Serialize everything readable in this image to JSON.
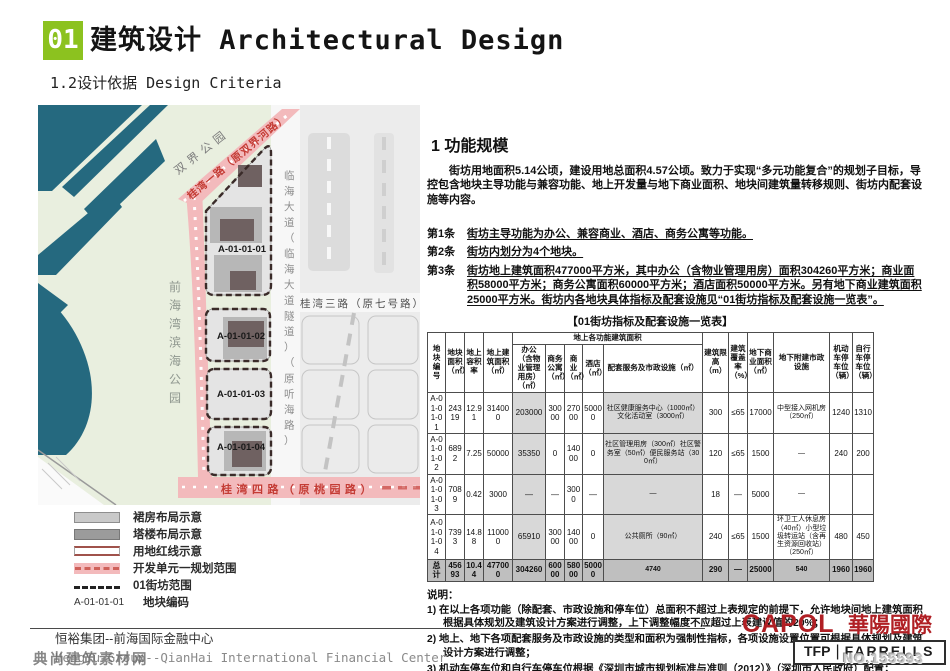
{
  "header": {
    "section_no": "01",
    "title": "建筑设计 Architectural Design",
    "subtitle": "1.2设计依据 Design Criteria"
  },
  "map": {
    "labels": {
      "park_top": "双界公园",
      "park_left": "前海湾滨海公园",
      "road_guiwan1": "桂湾一路（原双界河路）",
      "road_linhai": "临海大道（临海大道隧道）（原听海路）",
      "road_guiwan3": "桂湾三路（原七号路）",
      "road_guiwan4": "桂湾四路（原桃园路）",
      "plot1": "A-01-01-01",
      "plot2": "A-01-01-02",
      "plot3": "A-01-01-03",
      "plot4": "A-01-01-04"
    }
  },
  "legend": {
    "items": [
      {
        "type": "podium",
        "label": "裙房布局示意"
      },
      {
        "type": "tower",
        "label": "塔楼布局示意"
      },
      {
        "type": "redline",
        "label": "用地红线示意"
      },
      {
        "type": "unit-range",
        "label": "开发单元一规划范围"
      },
      {
        "type": "block-range",
        "label": "01街坊范围"
      },
      {
        "type": "plot-code",
        "code": "A-01-01-01",
        "label": "地块编码"
      }
    ]
  },
  "content": {
    "section_title": "1 功能规模",
    "intro": "街坊用地面积5.14公顷，建设用地总面积4.57公顷。致力于实现“多元功能复合”的规划子目标，导控包含地块主导功能与兼容功能、地上开发量与地下商业面积、地块间建筑量转移规则、街坊内配套设施等内容。",
    "articles": [
      {
        "no": "第1条",
        "text": "街坊主导功能为办公、兼容商业、酒店、商务公寓等功能。"
      },
      {
        "no": "第2条",
        "text": "街坊内划分为4个地块。"
      },
      {
        "no": "第3条",
        "text": "街坊地上建筑面积477000平方米，其中办公（含物业管理用房）面积304260平方米；商业面积58000平方米；商务公寓面积60000平方米；酒店面积50000平方米。另有地下商业建筑面积25000平方米。街坊内各地块具体指标及配套设施见“01街坊指标及配套设施一览表”。"
      }
    ],
    "table": {
      "caption": "【01街坊指标及配套设施一览表】",
      "group_header": "地上各功能建筑面积",
      "columns": [
        "地块编号",
        "地块面积（㎡）",
        "地上容积率",
        "地上建筑面积（㎡）",
        "办公（含物业管理用房）（㎡）",
        "商务公寓（㎡）",
        "商业（㎡）",
        "酒店（㎡）",
        "配套服务及市政设施（㎡）",
        "建筑限高（m）",
        "建筑覆盖率（%）",
        "地下商业面积（㎡）",
        "地下附建市政设施",
        "机动车停车位（辆）",
        "自行车停车位（辆）"
      ],
      "rows": [
        [
          "A-01-01-01",
          "24319",
          "12.91",
          "314000",
          "203000",
          "30000",
          "27000",
          "50000",
          "社区健康服务中心（1000㎡）文化活动室（3000㎡）",
          "300",
          "≤65",
          "17000",
          "中型接入网机房（250㎡）",
          "1240",
          "1310"
        ],
        [
          "A-01-01-02",
          "6892",
          "7.25",
          "50000",
          "35350",
          "0",
          "14000",
          "0",
          "社区管理用房（300㎡）社区警务室（50㎡）便民服务站（300㎡）",
          "120",
          "≤65",
          "1500",
          "—",
          "240",
          "200"
        ],
        [
          "A-01-01-03",
          "7089",
          "0.42",
          "3000",
          "—",
          "—",
          "3000",
          "—",
          "—",
          "18",
          "—",
          "5000",
          "—",
          "",
          ""
        ],
        [
          "A-01-01-04",
          "7393",
          "14.88",
          "110000",
          "65910",
          "30000",
          "14000",
          "0",
          "公共厕所（90㎡）",
          "240",
          "≤65",
          "1500",
          "环卫工人休息房（40㎡）小型垃圾转运站（含再生资源回收站）（250㎡）",
          "480",
          "450"
        ]
      ],
      "total_row": [
        "总计",
        "45693",
        "10.44",
        "477000",
        "304260",
        "60000",
        "58000",
        "50000",
        "4740",
        "290",
        "—",
        "25000",
        "540",
        "1960",
        "1960"
      ]
    },
    "notes": {
      "title": "说明：",
      "items": [
        "1) 在以上各项功能（除配套、市政设施和停车位）总面积不超过上表规定的前提下，允许地块间地上建筑面积根据具体规划及建筑设计方案进行调整，上下调整幅度不应超过上表建议值的20%；",
        "2) 地上、地下各项配套服务及市政设施的类型和面积为强制性指标，各项设施设置位置可根据具体规划及建筑设计方案进行调整；",
        "3) 机动车停车位和自行车停车位根据《深圳市城市规划标准与准则（2012）》（深圳市人民政府）配置；",
        "4) 物业管理用房根据《深圳经济特区物业管理条例》（深圳市人民代表大会常务委员会公告第57号 ）配置。"
      ]
    }
  },
  "footer": {
    "project_zh": "恒裕集团--前海国际金融中心",
    "project_en": "HengYu Group--QianHai International Financial Center",
    "logo_capol_en": "CAPOL",
    "logo_capol_zh": "華陽國際",
    "logo_tfp": "TFP",
    "logo_farrells": "FARRELLS"
  },
  "watermarks": {
    "site": "典尚建筑素材网",
    "serial": "NO.155593"
  },
  "colors": {
    "accent_green": "#8cc21f",
    "capol_red": "#b01f24",
    "map_water": "#25697f",
    "map_park": "#e9efdf",
    "map_road_pink": "#f3babc",
    "map_red_text": "#c43c35",
    "table_shade": "#d8d8d8",
    "table_total": "#bfbfbf"
  }
}
